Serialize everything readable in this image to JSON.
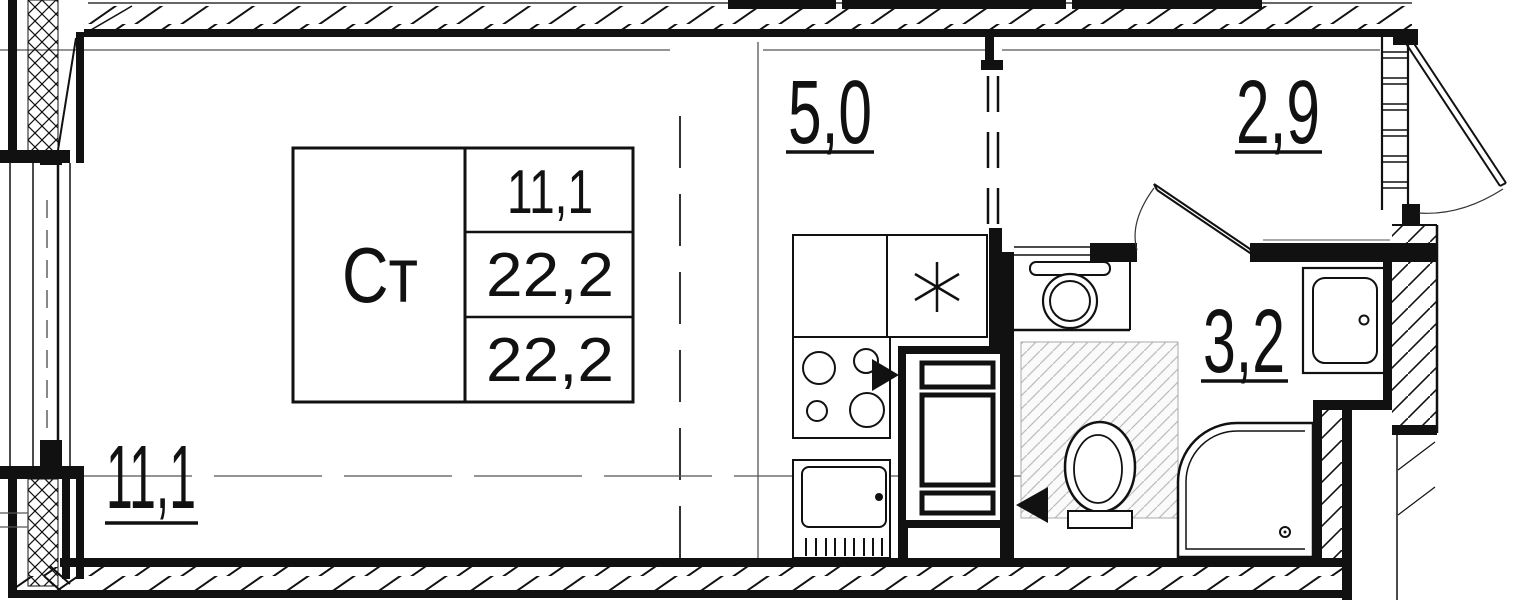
{
  "title": "Studio apartment floor plan",
  "unit_card": {
    "type_label": "Ст",
    "row_values": [
      "11,1",
      "22,2",
      "22,2"
    ]
  },
  "rooms": {
    "living": {
      "area": "11,1"
    },
    "kitchen": {
      "area": "5,0"
    },
    "hall": {
      "area": "2,9"
    },
    "bathroom": {
      "area": "3,2"
    }
  },
  "symbols": {
    "kitchen_sink_mark": "asterisk",
    "door_swing_arrows": "filled-triangles"
  },
  "colors": {
    "ink": "#111111",
    "thin_line": "#555555",
    "wet_zone_hatch": "#bdbdbd",
    "background": "#ffffff"
  }
}
